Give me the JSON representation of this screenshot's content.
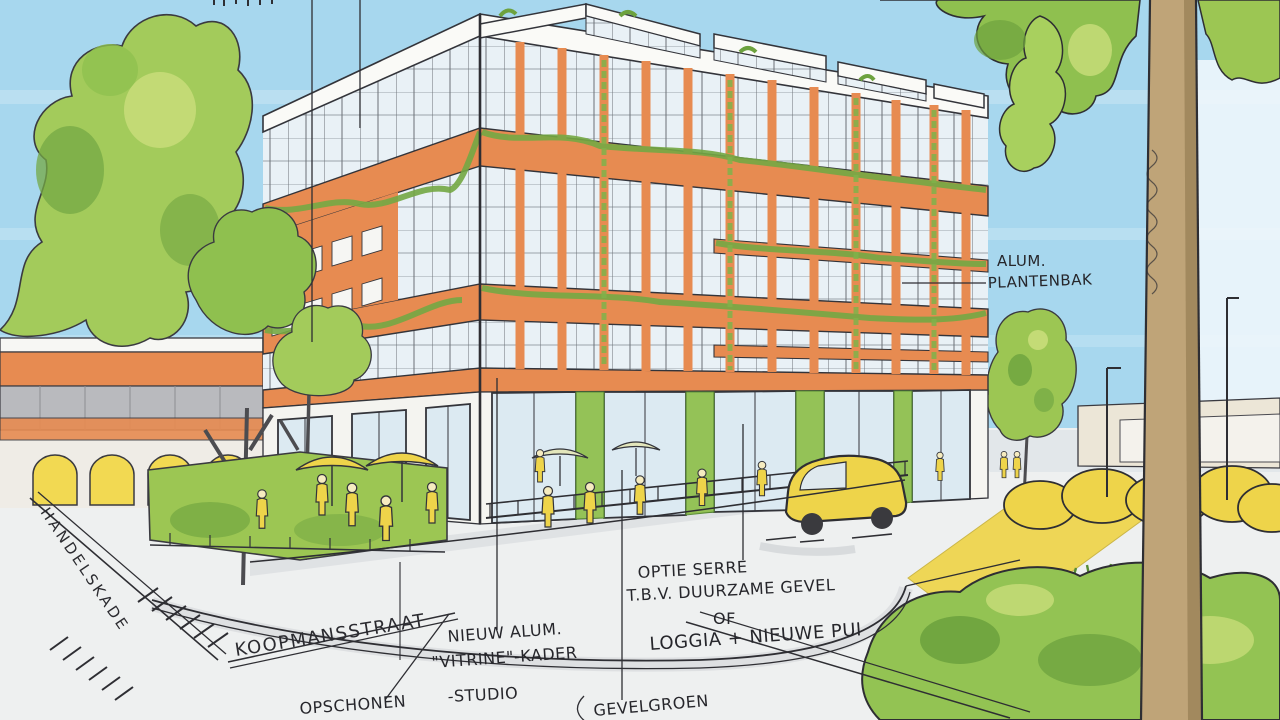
{
  "annotations": {
    "plantenbak": {
      "line1": "ALUM.",
      "line2": "PLANTENBAK"
    },
    "vitrine": {
      "line1": "NIEUW ALUM.",
      "line2": "\"VITRINE\"-KADER",
      "line3": "-STUDIO"
    },
    "opschonen": {
      "label": "OPSCHONEN"
    },
    "serre": {
      "line1": "OPTIE SERRE",
      "line2": "T.B.V. DUURZAME GEVEL",
      "line3": "OF",
      "line4": "LOGGIA + NIEUWE PUI"
    },
    "gevelgroen": {
      "label": "GEVELGROEN"
    }
  },
  "streets": {
    "handelskade": "HANDELSKADE",
    "koopmansstraat": "KOOPMANSSTRAAT"
  },
  "palette": {
    "sky": "#a7d7ee",
    "foliage_light": "#c9dd7a",
    "foliage_mid": "#8fc04f",
    "foliage_dark": "#6da23e",
    "terracotta": "#e78b51",
    "terracotta_dark": "#d9753c",
    "accent_yellow": "#eed44a",
    "trunk_brown": "#bfa478",
    "ink": "#2e2e33",
    "pavement": "#eef0f0",
    "glass": "#e9f1f6"
  }
}
